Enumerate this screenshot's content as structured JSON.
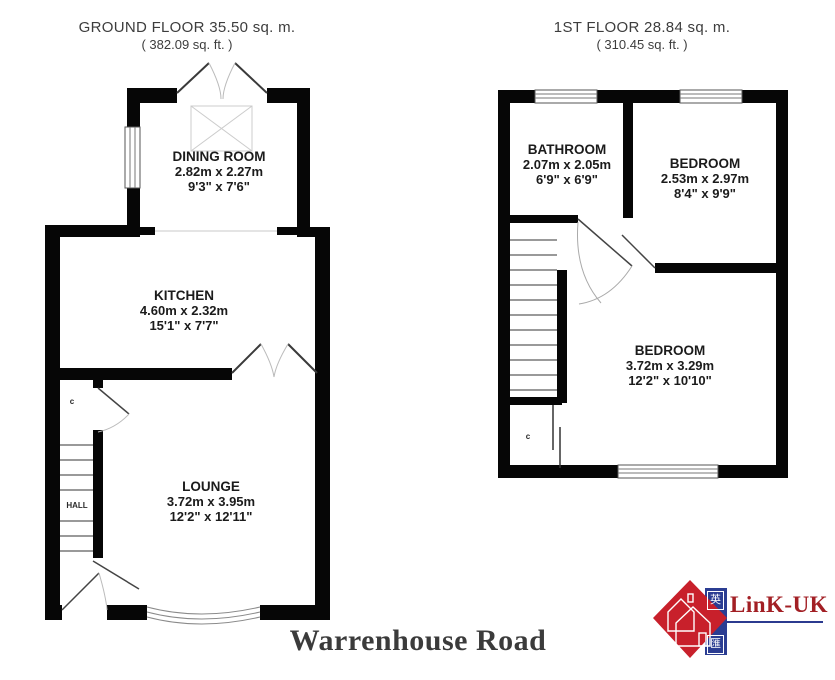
{
  "ground_floor": {
    "header_line1": "GROUND FLOOR 35.50 sq. m.",
    "header_line2": "( 382.09 sq. ft. )",
    "rooms": [
      {
        "name": "DINING ROOM",
        "metric": "2.82m x 2.27m",
        "imperial": "9'3\" x 7'6\""
      },
      {
        "name": "KITCHEN",
        "metric": "4.60m x 2.32m",
        "imperial": "15'1\" x 7'7\""
      },
      {
        "name": "LOUNGE",
        "metric": "3.72m x 3.95m",
        "imperial": "12'2\" x 12'11\""
      }
    ],
    "hall_label": "HALL",
    "cupboard_label": "c"
  },
  "first_floor": {
    "header_line1": "1ST FLOOR 28.84 sq. m.",
    "header_line2": "( 310.45 sq. ft. )",
    "rooms": [
      {
        "name": "BATHROOM",
        "metric": "2.07m x 2.05m",
        "imperial": "6'9\" x 6'9\""
      },
      {
        "name": "BEDROOM",
        "metric": "2.53m x 2.97m",
        "imperial": "8'4\" x 9'9\""
      },
      {
        "name": "BEDROOM",
        "metric": "3.72m x 3.29m",
        "imperial": "12'2\" x 10'10\""
      }
    ],
    "cupboard_label": "c"
  },
  "title": "Warrenhouse Road",
  "logo": {
    "text": "LinK-UK",
    "char_top": "英",
    "char_bottom": "匯",
    "colors": {
      "red": "#c8202b",
      "blue": "#2b3d92",
      "wordmark": "#a21f24",
      "underline": "#2b3a8f"
    }
  },
  "colors": {
    "walls": "#060606",
    "labels": "#1b1b1b",
    "headers": "#3d3d3d"
  }
}
